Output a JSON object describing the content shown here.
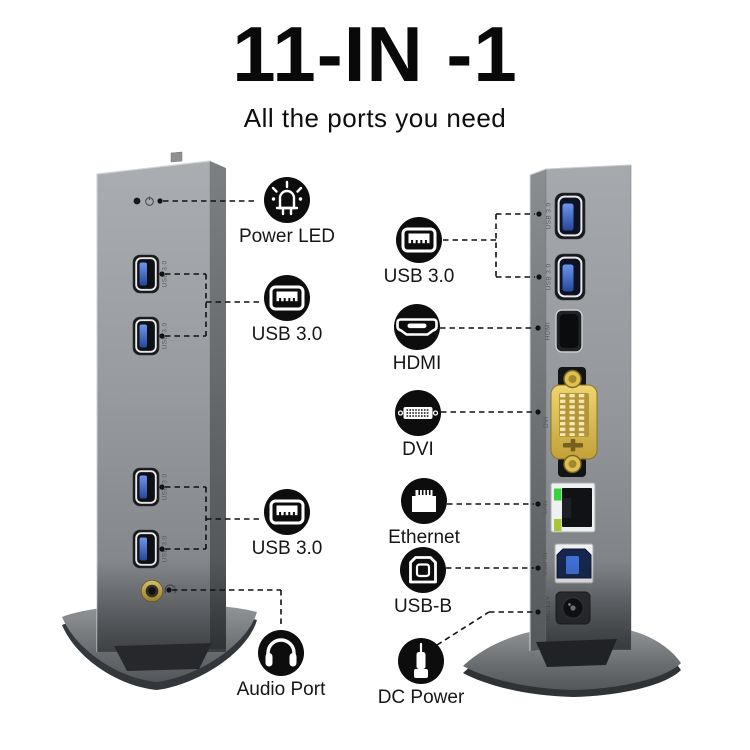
{
  "header": {
    "title": "11-IN -1",
    "subtitle": "All the ports you need"
  },
  "front_view": {
    "port_labels": [
      "USB 3.0",
      "USB 3.0",
      "USB 3.0",
      "USB 3.0"
    ]
  },
  "back_view": {
    "port_labels": {
      "usb1": "USB 3.0",
      "usb2": "USB 3.0",
      "hdmi": "HDMI",
      "dvi": "DVI",
      "lan": "LAN",
      "usb_b": "USB IN",
      "dc": "DC 12V"
    }
  },
  "callouts": {
    "power_led": "Power LED",
    "usb_front_top": "USB 3.0",
    "usb_front_bottom": "USB 3.0",
    "audio": "Audio Port",
    "usb_back": "USB 3.0",
    "hdmi": "HDMI",
    "dvi": "DVI",
    "ethernet": "Ethernet",
    "usb_b": "USB-B",
    "dc_power": "DC Power"
  },
  "colors": {
    "callout_black": "#0d0d0d",
    "usb_blue": "#3a63c0",
    "connector_gold": "#d8b94a",
    "lan_led_green": "#36d33a",
    "lan_led_yellow": "#aac72e",
    "body_gray": "#9a9da1"
  }
}
